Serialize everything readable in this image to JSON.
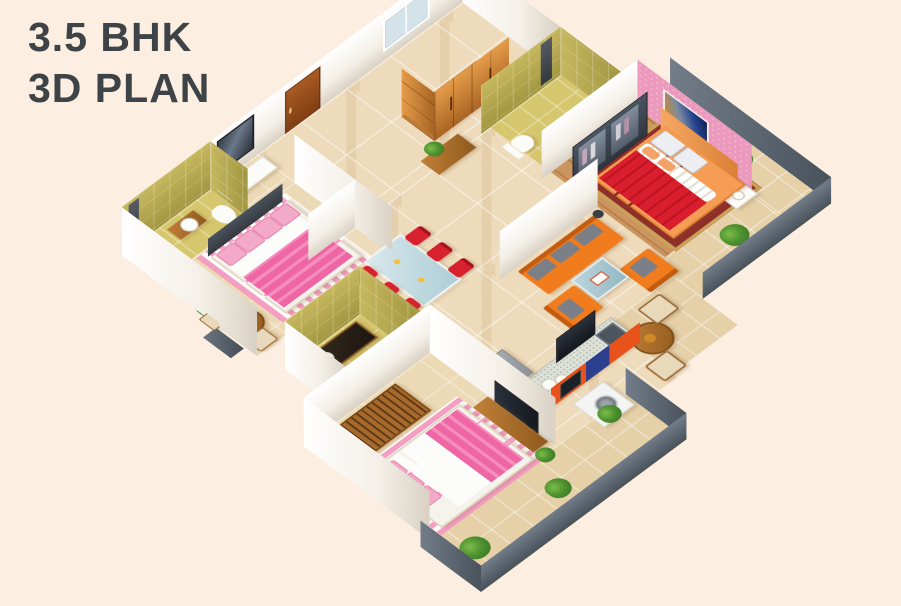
{
  "title": {
    "line1": "3.5 BHK",
    "line2": "3D PLAN"
  },
  "palette": {
    "background": "#fcefe1",
    "title_text": "#3e4347",
    "wall_white": "#f4efe7",
    "bathroom_olive_wall": "#b3a74d",
    "bathroom_olive_floor": "#d6c76e",
    "floor_marble": "#eedbbc",
    "floor_wood_plank": "#cb9560",
    "accent_wall_pink": "#eb9abd",
    "sofa_orange": "#f07c1e",
    "dining_chair_red": "#d8212f",
    "bed_pink": "#ee66a4",
    "master_bed_red": "#d91e2e",
    "bed_frame_orange": "#f59c55",
    "kitchen_cabinet_orange": "#e8531b",
    "kitchen_cabinet_blue": "#2c3f8e",
    "wardrobe_wood": "#c07a30",
    "plant_green": "#4e9230",
    "balcony_parapet_gray": "#5c6670",
    "tv_dark": "#20262e"
  },
  "scene": {
    "type": "isometric 3D apartment floor plan render",
    "rooms": [
      {
        "name": "bedroom-1",
        "items": [
          "double bed with pink bedding",
          "pink striped rug",
          "dark headboard",
          "dresser with mirror",
          "sit-out with round table, two chairs and plant"
        ]
      },
      {
        "name": "bathroom-1",
        "items": [
          "shower panel",
          "wash basin cabinet",
          "toilet"
        ]
      },
      {
        "name": "foyer",
        "items": [
          "entrance steps",
          "wooden door",
          "window",
          "tall wooden wardrobe",
          "wooden sideboard with plant",
          "slatted crockery chest"
        ]
      },
      {
        "name": "master-bathroom",
        "items": [
          "shower panel",
          "wall-hung toilet"
        ]
      },
      {
        "name": "master-bedroom",
        "items": [
          "sliding glass wardrobe with clothes",
          "pink accent wall with abstract painting",
          "orange bed with red blanket",
          "patterned rug",
          "white nightstand with lamp",
          "wooden plank floor"
        ]
      },
      {
        "name": "dining-area",
        "items": [
          "glass dining table",
          "six red chairs"
        ]
      },
      {
        "name": "living-room",
        "items": [
          "orange three-seat sofa with gray cushions",
          "orange armchair",
          "orange single seat",
          "blue coffee table",
          "floor lamps"
        ]
      },
      {
        "name": "kitchen",
        "items": [
          "granite L-counter",
          "orange and blue cabinets",
          "sink",
          "TV on peninsula",
          "refrigerator",
          "plates"
        ]
      },
      {
        "name": "utility",
        "items": [
          "washing machine"
        ]
      },
      {
        "name": "common-bathroom",
        "items": [
          "granite vanity with basin",
          "toilet"
        ]
      },
      {
        "name": "bedroom-3",
        "items": [
          "bed with pink blanket",
          "striped rug",
          "slatted wooden wardrobe",
          "TV console",
          "stool with plant"
        ]
      },
      {
        "name": "balconies",
        "items": [
          "round wooden table with two chairs",
          "potted plants",
          "dark parapet walls",
          "washing area"
        ]
      }
    ]
  }
}
